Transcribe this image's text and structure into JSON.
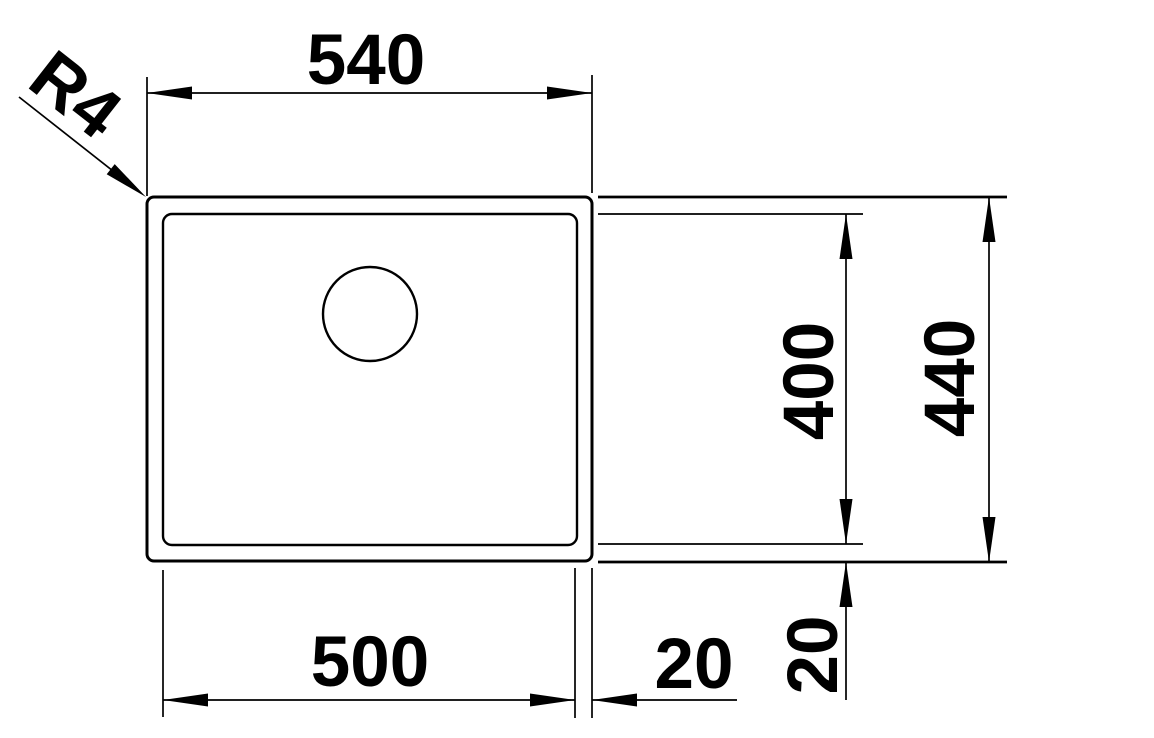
{
  "drawing": {
    "background_color": "#ffffff",
    "line_color": "#000000",
    "labels": {
      "overall_width": "540",
      "overall_depth": "440",
      "bowl_width": "500",
      "bowl_depth": "400",
      "rim_offset_right": "20",
      "rim_offset_bottom": "20",
      "corner_radius": "R4"
    }
  }
}
